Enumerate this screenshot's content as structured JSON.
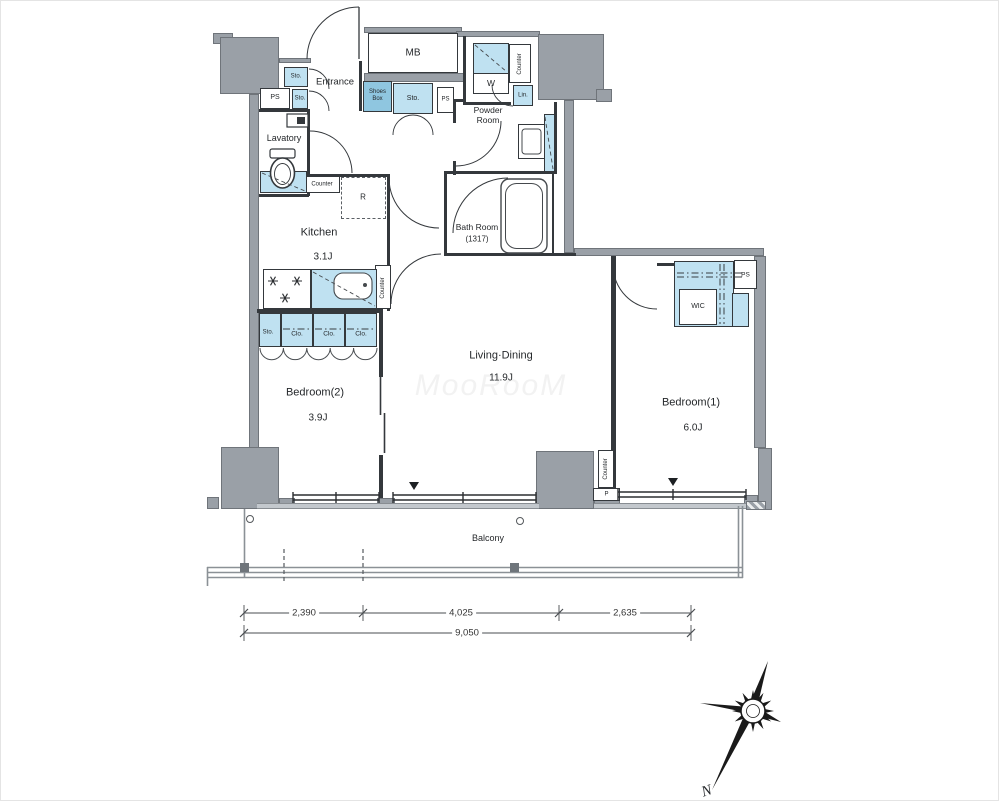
{
  "rooms": {
    "entrance": "Entrance",
    "lavatory": "Lavatory",
    "powder_room": "Powder Room",
    "bath_room": "Bath Room",
    "bath_size": "(1317)",
    "kitchen": "Kitchen",
    "kitchen_size": "3.1J",
    "living_dining": "Living·Dining",
    "living_dining_size": "11.9J",
    "bedroom1": "Bedroom(1)",
    "bedroom1_size": "6.0J",
    "bedroom2": "Bedroom(2)",
    "bedroom2_size": "3.9J",
    "wic": "WIC",
    "balcony": "Balcony"
  },
  "fx": {
    "mb": "MB",
    "w": "W",
    "lin": "Lin.",
    "r": "R",
    "p": "P",
    "shoes_box": "Shoes Box",
    "sto": "Sto.",
    "clo": "Clo.",
    "ps": "PS",
    "counter": "Counter"
  },
  "dim": {
    "seg1": "2,390",
    "seg2": "4,025",
    "seg3": "2,635",
    "total": "9,050"
  },
  "compass": {
    "north": "N"
  },
  "watermark": "MooRooM",
  "colors": {
    "wall_gray": "#9aa0a7",
    "fixture_blue": "#bfe1f1",
    "shoes_blue": "#8fc6e0",
    "line_dark": "#34383c"
  }
}
